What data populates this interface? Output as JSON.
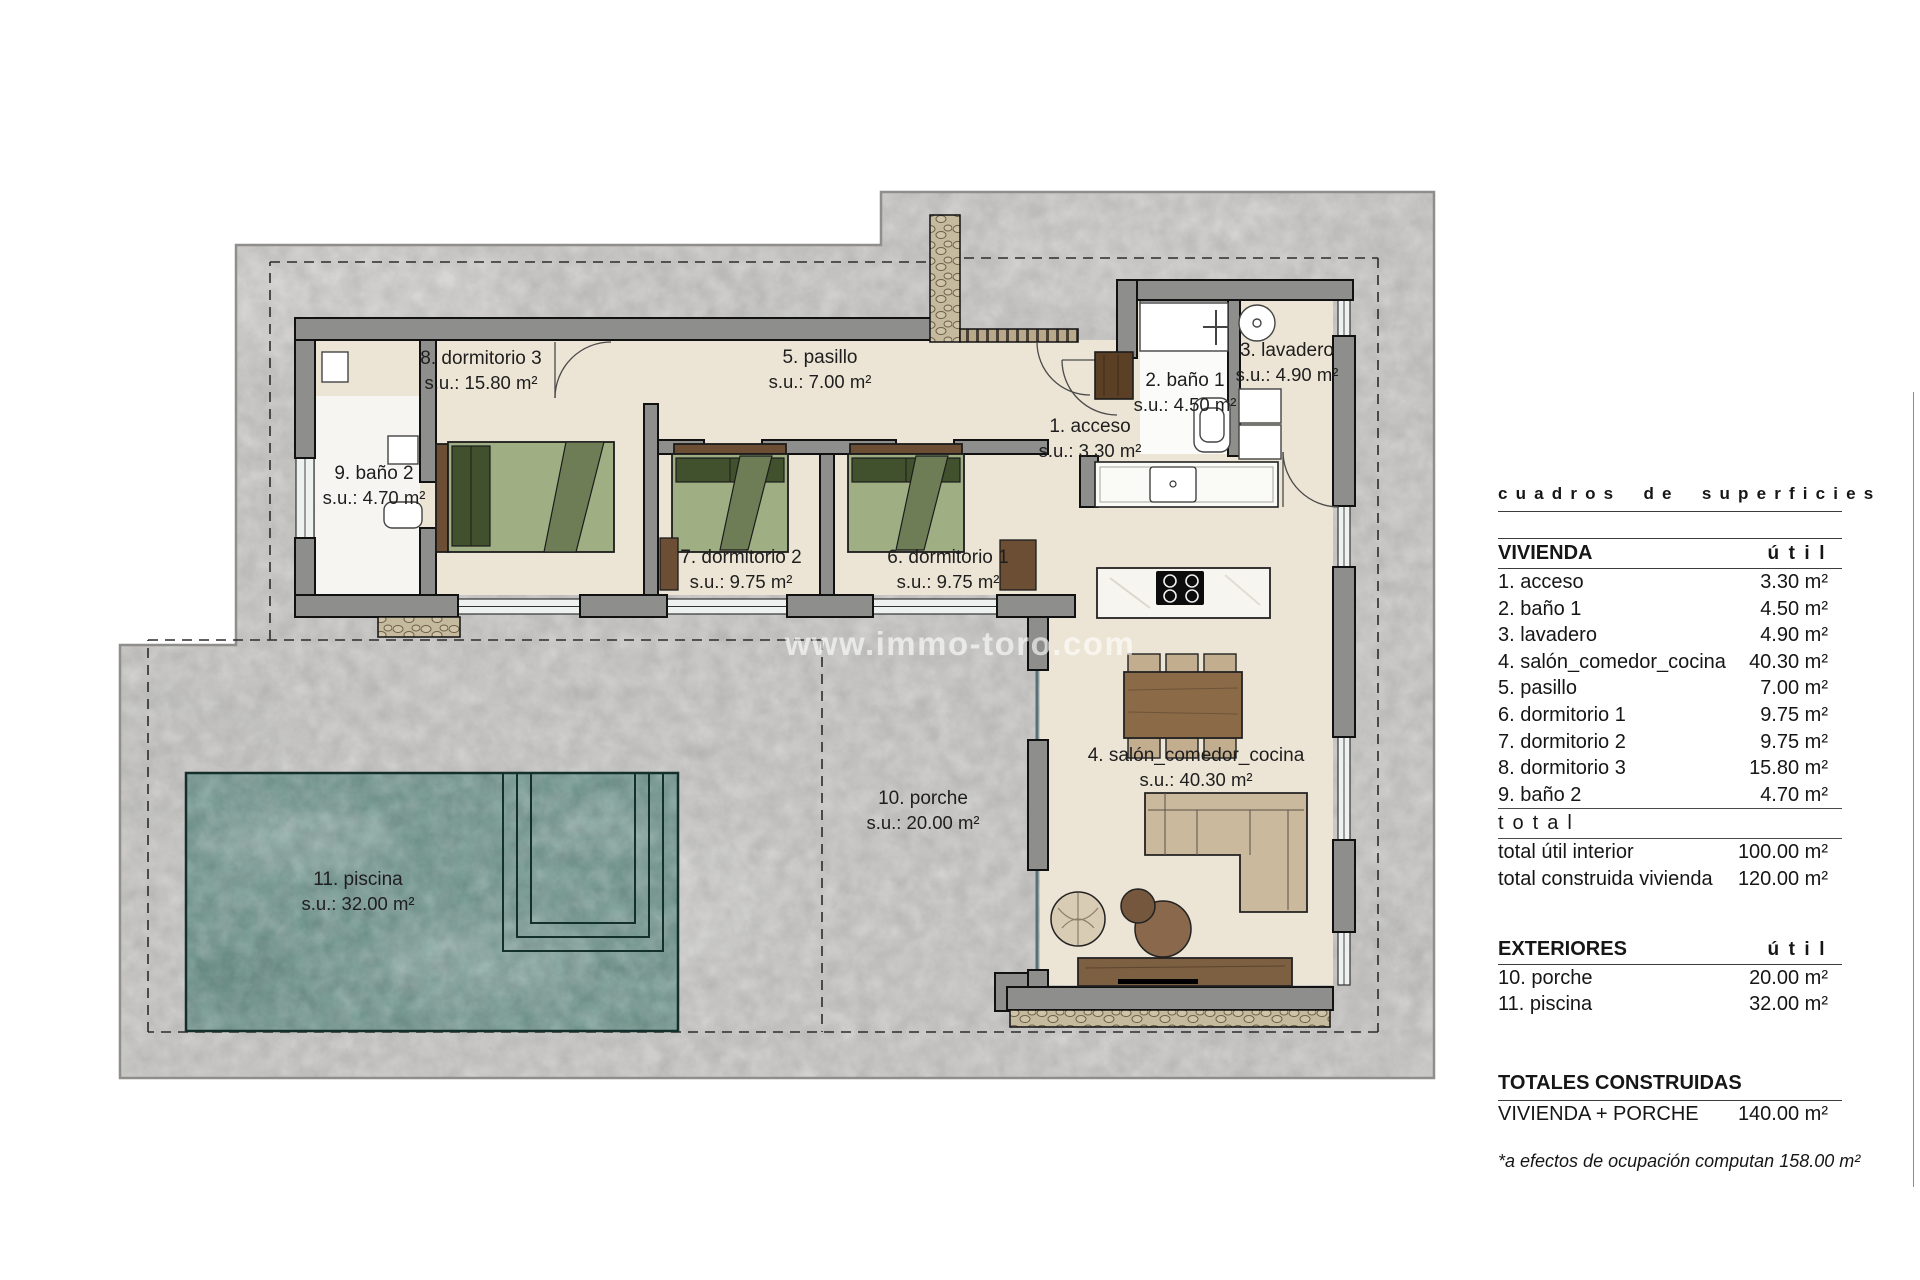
{
  "watermark": "www.immo-toro.com",
  "plan": {
    "rooms": [
      {
        "id": "dormitorio3",
        "label": "8. dormitorio 3",
        "area": "s.u.: 15.80 m²"
      },
      {
        "id": "pasillo",
        "label": "5. pasillo",
        "area": "s.u.: 7.00 m²"
      },
      {
        "id": "lavadero",
        "label": "3. lavadero",
        "area": "s.u.: 4.90 m²"
      },
      {
        "id": "bano1",
        "label": "2. baño 1",
        "area": "s.u.: 4.50 m²"
      },
      {
        "id": "acceso",
        "label": "1. acceso",
        "area": "s.u.: 3.30 m²"
      },
      {
        "id": "bano2",
        "label": "9. baño 2",
        "area": "s.u.: 4.70 m²"
      },
      {
        "id": "dormitorio2",
        "label": "7. dormitorio 2",
        "area": "s.u.: 9.75 m²"
      },
      {
        "id": "dormitorio1",
        "label": "6. dormitorio 1",
        "area": "s.u.: 9.75 m²"
      },
      {
        "id": "salon",
        "label": "4. salón_comedor_cocina",
        "area": "s.u.: 40.30 m²"
      },
      {
        "id": "porche",
        "label": "10. porche",
        "area": "s.u.: 20.00 m²"
      },
      {
        "id": "piscina",
        "label": "11. piscina",
        "area": "s.u.: 32.00 m²"
      }
    ]
  },
  "table": {
    "title": "cuadros de superficies",
    "vivienda": {
      "header": "VIVIENDA",
      "util_header": "útil",
      "rows": [
        {
          "label": "1. acceso",
          "value": "3.30 m²"
        },
        {
          "label": "2. baño 1",
          "value": "4.50 m²"
        },
        {
          "label": "3. lavadero",
          "value": "4.90 m²"
        },
        {
          "label": "4. salón_comedor_cocina",
          "value": "40.30 m²"
        },
        {
          "label": "5. pasillo",
          "value": "7.00 m²"
        },
        {
          "label": "6. dormitorio 1",
          "value": "9.75 m²"
        },
        {
          "label": "7. dormitorio 2",
          "value": "9.75 m²"
        },
        {
          "label": "8. dormitorio 3",
          "value": "15.80 m²"
        },
        {
          "label": "9. baño 2",
          "value": "4.70 m²"
        }
      ],
      "total_label": "total",
      "totals": [
        {
          "label": "total útil interior",
          "value": "100.00 m²"
        },
        {
          "label": "total construida vivienda",
          "value": "120.00 m²"
        }
      ]
    },
    "exteriores": {
      "header": "EXTERIORES",
      "util_header": "útil",
      "rows": [
        {
          "label": "10. porche",
          "value": "20.00 m²"
        },
        {
          "label": "11. piscina",
          "value": "32.00 m²"
        }
      ]
    },
    "totales": {
      "header": "TOTALES CONSTRUIDAS",
      "rows": [
        {
          "label": "VIVIENDA + PORCHE",
          "value": "140.00 m²"
        }
      ]
    },
    "footnote": "*a efectos de ocupación computan 158.00 m²"
  },
  "colors": {
    "parcel": "#c8c7c5",
    "wall": "#8e8e8c",
    "floor": "#ece4d4",
    "pool": "#6f9a92",
    "wood": "#7d5f41",
    "bed_green": "#9fae83"
  }
}
